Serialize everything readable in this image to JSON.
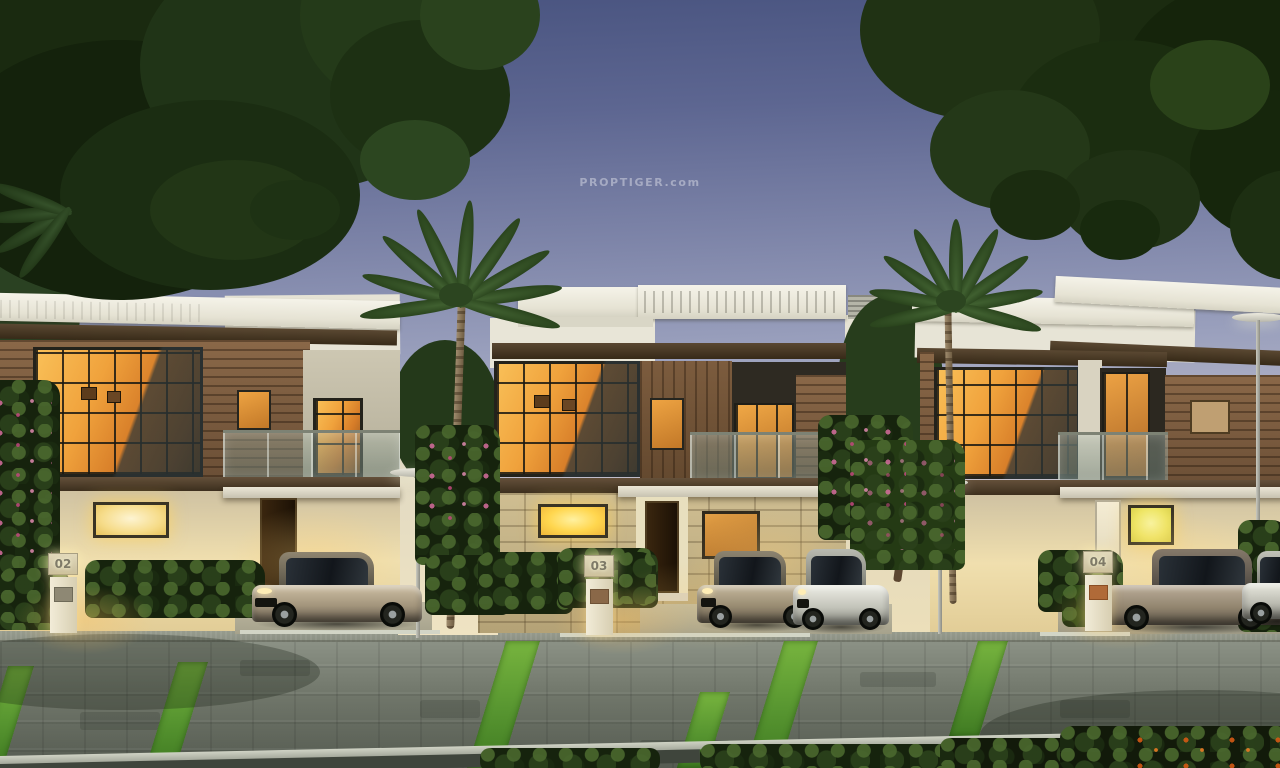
{
  "watermark": {
    "text": "PROPTIGER.com"
  },
  "houses": [
    {
      "number": "02"
    },
    {
      "number": "03"
    },
    {
      "number": "04"
    }
  ],
  "palette": {
    "sky_top": "#48537f",
    "sky_mid": "#9aa0bd",
    "sky_horizon": "#ded6d2",
    "window_glow_amber": "#f0a23c",
    "interior_light": "#ffd64e",
    "wood_panel": "#7c5c3e",
    "roof_white": "#eceade",
    "foliage_dark": "#1b2b10",
    "pavement_grey": "#70766a",
    "grass_strip_green": "#61a335"
  }
}
